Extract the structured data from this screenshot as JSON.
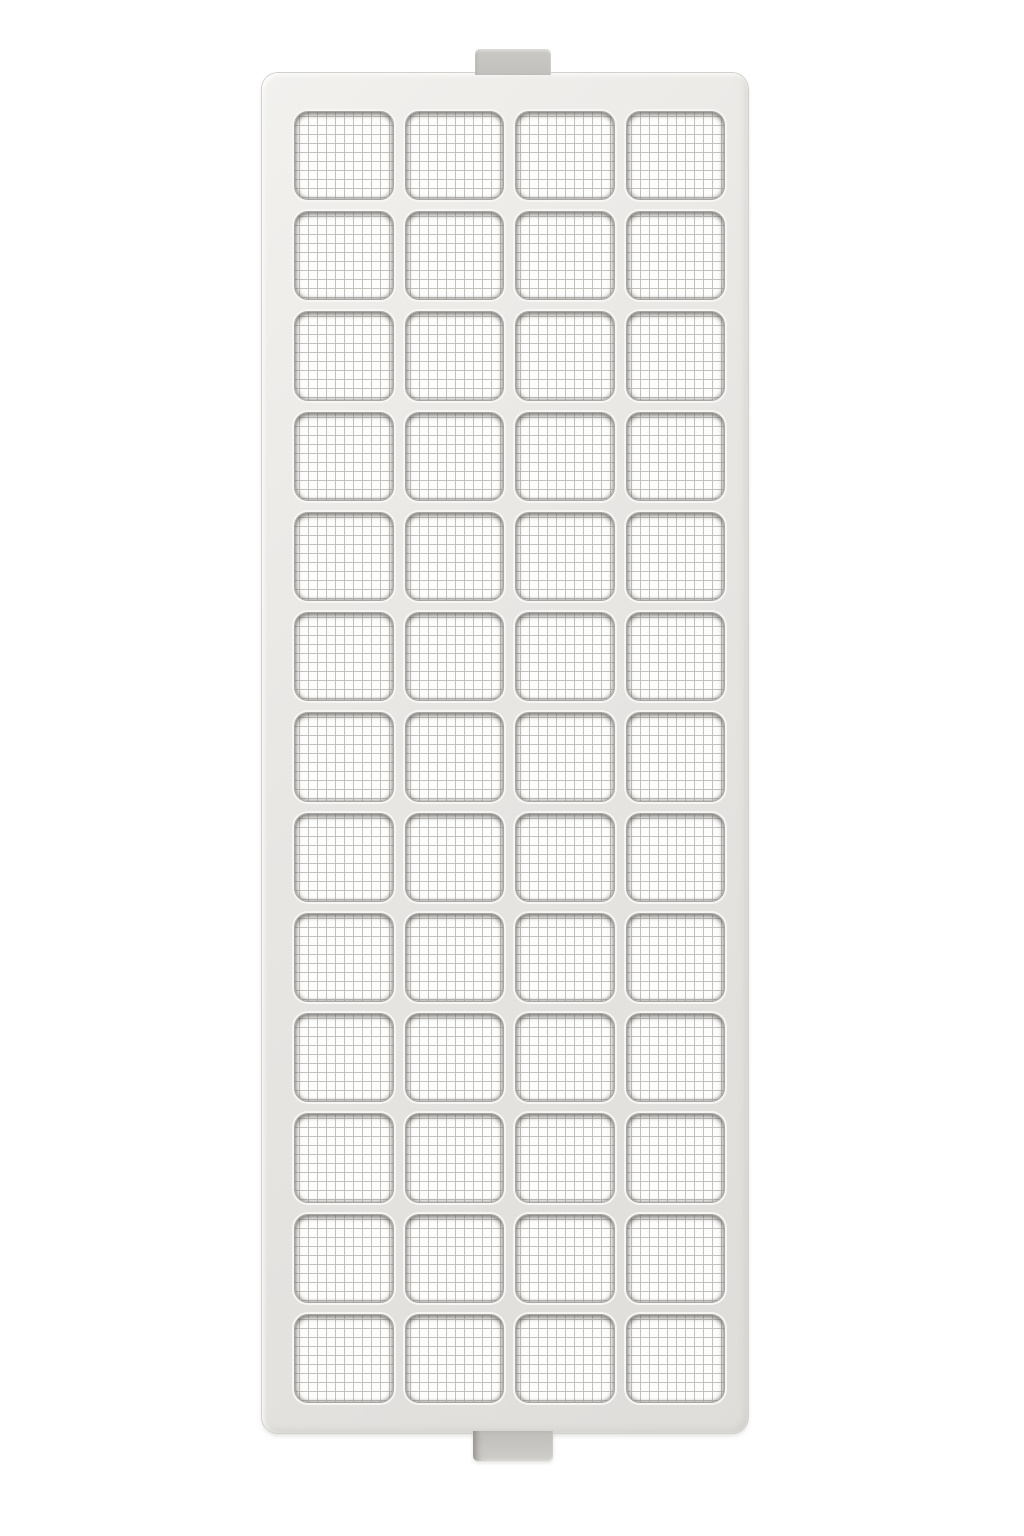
{
  "scene": {
    "type": "product-photo",
    "subject": "rectangular plastic air filter grille with fine wire mesh openings",
    "background_color": "#ffffff"
  },
  "filter": {
    "grid": {
      "rows": 13,
      "columns": 4
    },
    "tabs": {
      "top_count": 1,
      "bottom_count": 1
    },
    "colors": {
      "background": "#ffffff",
      "frame": "#e8e6e3",
      "frame_highlight": "#f2f1ee",
      "frame_shadow": "#dfddda",
      "frame_outline": "#d2d0cd",
      "cell_bevel": "#a9a7a3",
      "cell_rim_highlight": "#f7f6f4",
      "mesh_background": "#fdfdfc",
      "mesh_line": "#c3c1bd",
      "tab_face": "#cac8c4"
    }
  }
}
